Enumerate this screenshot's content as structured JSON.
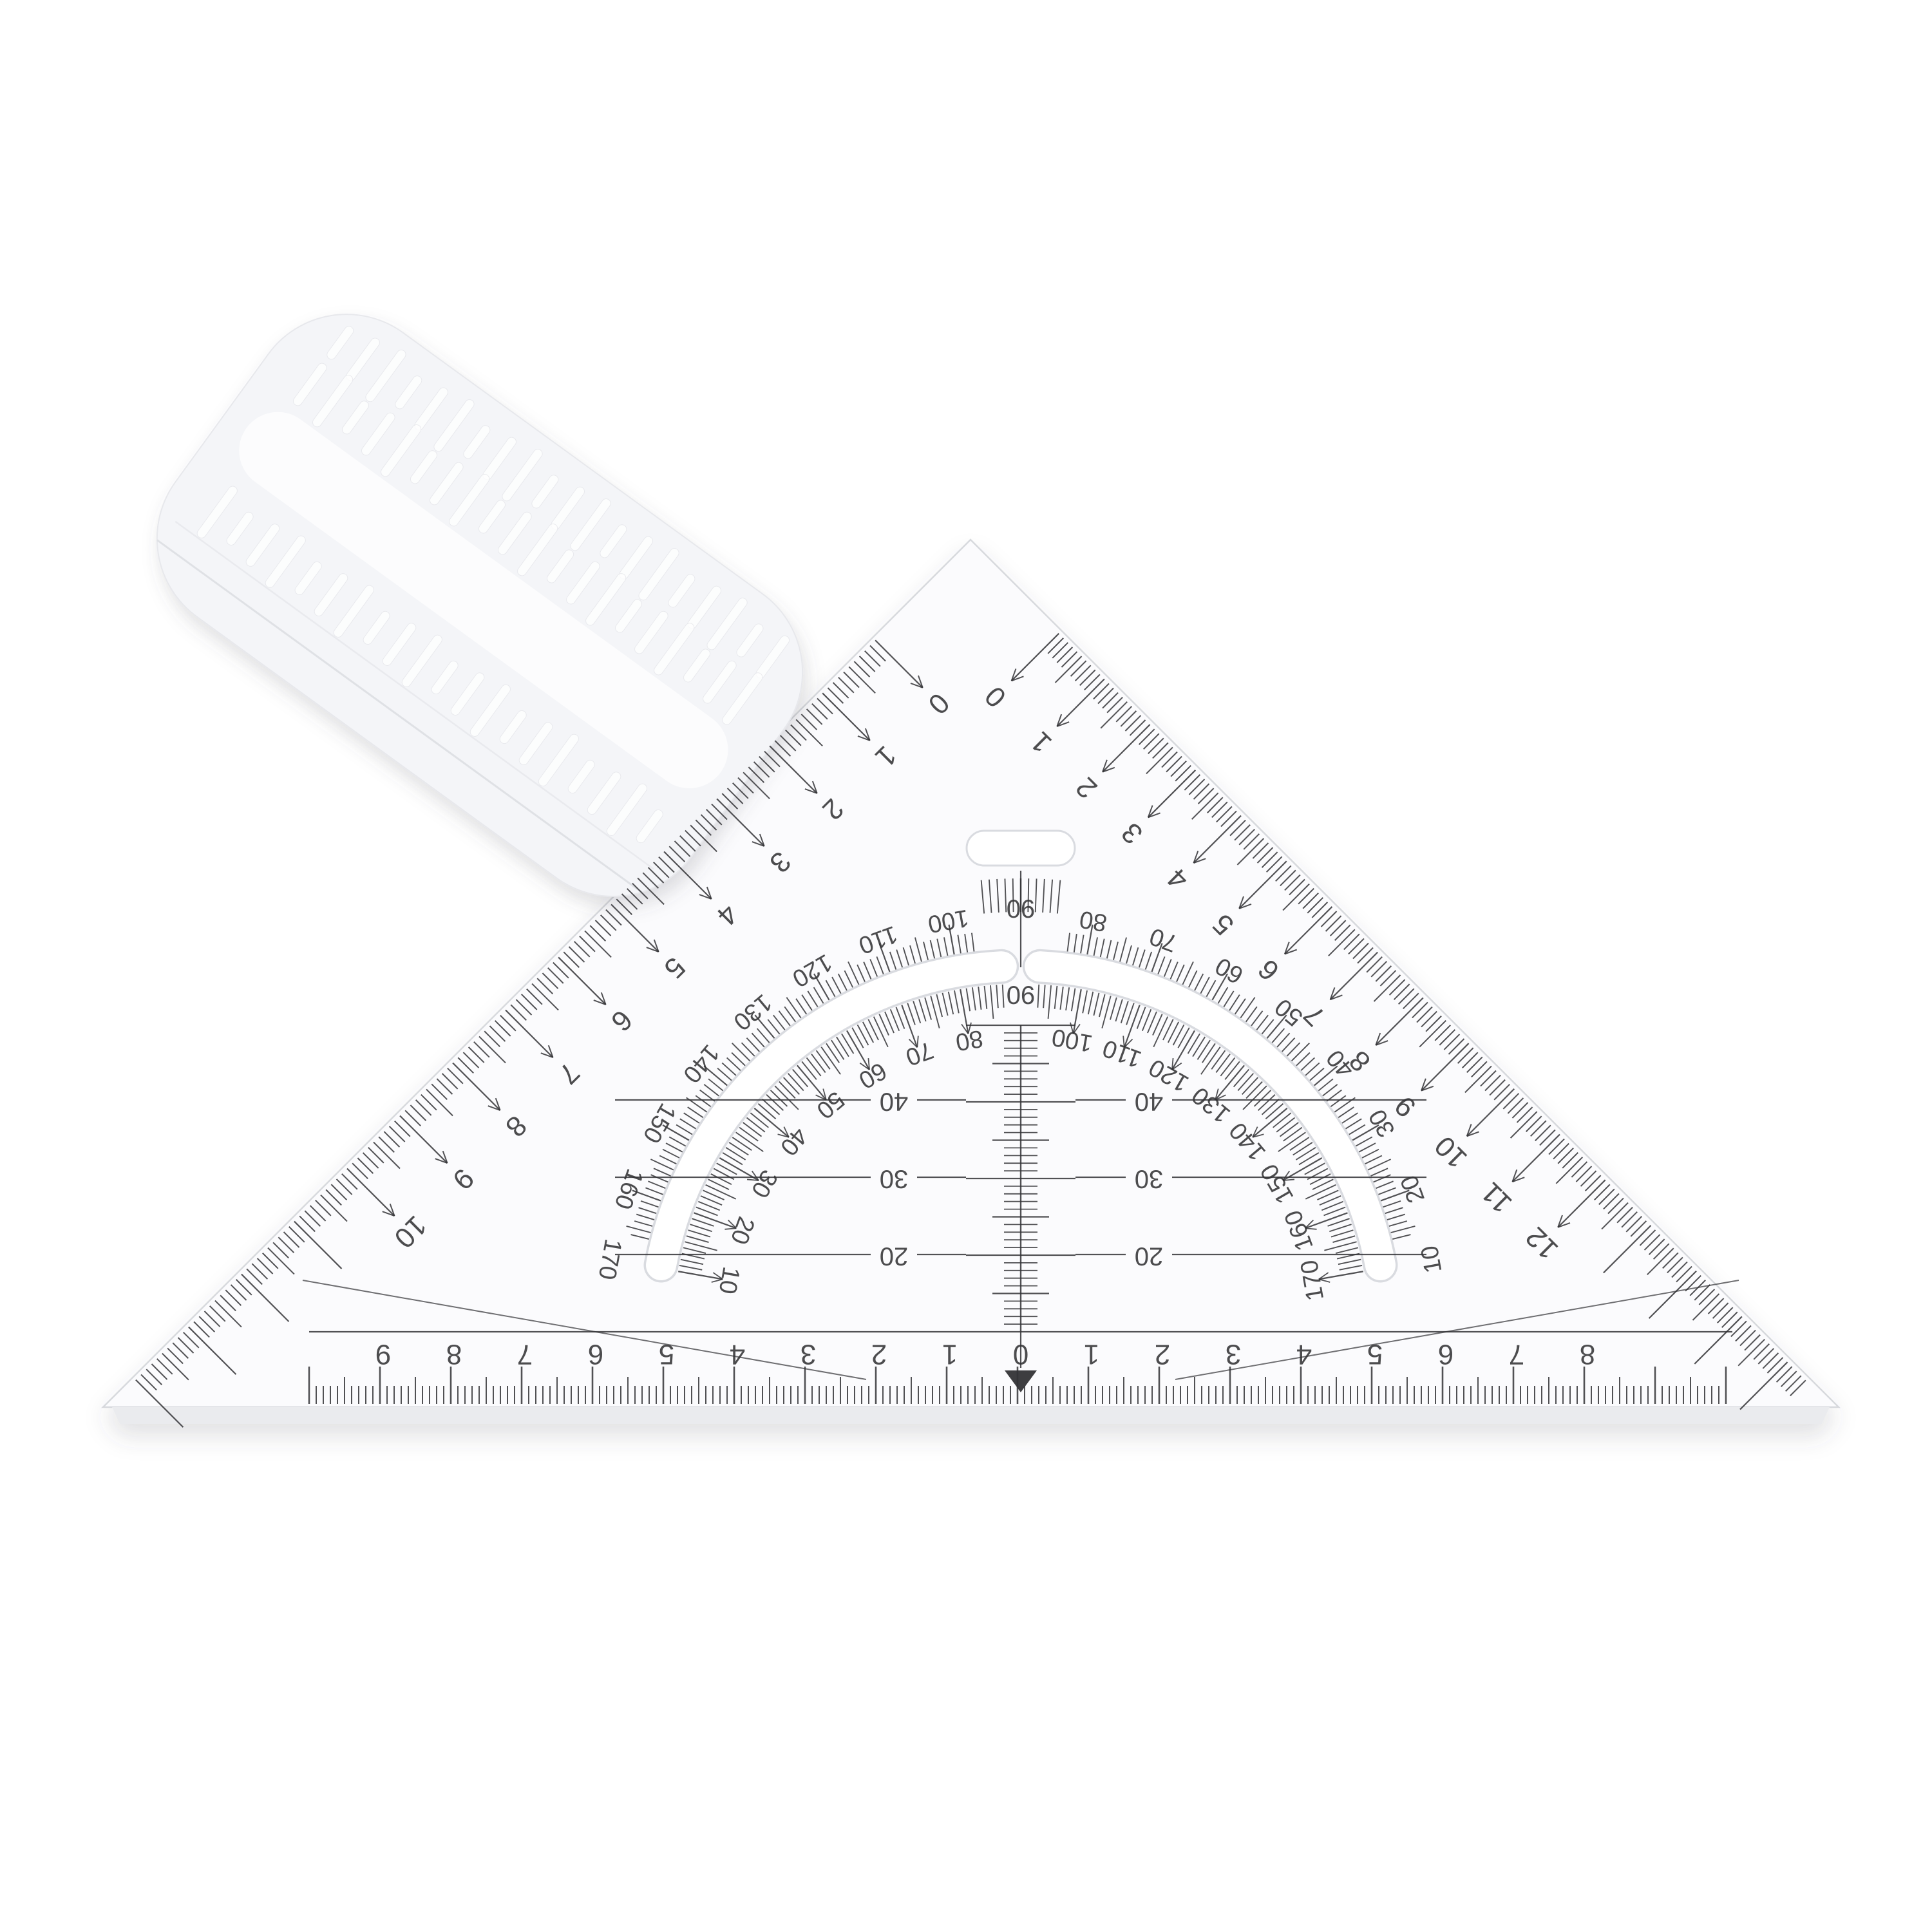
{
  "scene": {
    "description": "transparent 45-degree protractor set square with frosted grip bar",
    "background_color": "#ffffff",
    "plastic_color": "#fbfbfd",
    "frosted_color": "#f4f5f8",
    "edge_line_color": "#d7d9dd",
    "ink_color": "#333336",
    "shadow_color": "rgba(70,70,80,0.16)"
  },
  "grip_bar": {
    "kind": "frosted-grip-bar",
    "texture": "ribbed"
  },
  "edge_scale_left": {
    "labels": [
      "0",
      "1",
      "2",
      "3",
      "4",
      "5",
      "6",
      "7",
      "8",
      "9",
      "10"
    ]
  },
  "edge_scale_right": {
    "labels": [
      "0",
      "1",
      "2",
      "3",
      "4",
      "5",
      "6",
      "7",
      "8",
      "9",
      "10",
      "11",
      "12"
    ]
  },
  "bottom_scale": {
    "labels_left": [
      "9",
      "8",
      "7",
      "6",
      "5",
      "4",
      "3",
      "2",
      "1"
    ],
    "zero_label": "0",
    "labels_right": [
      "1",
      "2",
      "3",
      "4",
      "5",
      "6",
      "7",
      "8"
    ],
    "pointer_glyph": "▼"
  },
  "protractor": {
    "outer_scale": {
      "left_labels": [
        "100",
        "110",
        "120",
        "130",
        "140",
        "150",
        "160",
        "170"
      ],
      "top_label": "90",
      "right_labels": [
        "80",
        "70",
        "60",
        "50",
        "40",
        "30",
        "20",
        "10"
      ]
    },
    "inner_scale": {
      "left_labels": [
        "80",
        "70",
        "60",
        "50",
        "40",
        "30",
        "20",
        "10"
      ],
      "top_label": "90",
      "right_labels": [
        "100",
        "110",
        "120",
        "130",
        "140",
        "150",
        "160",
        "170"
      ]
    },
    "parallel_row_labels": [
      "40",
      "30",
      "20"
    ],
    "center_strip_top_label": "90"
  }
}
